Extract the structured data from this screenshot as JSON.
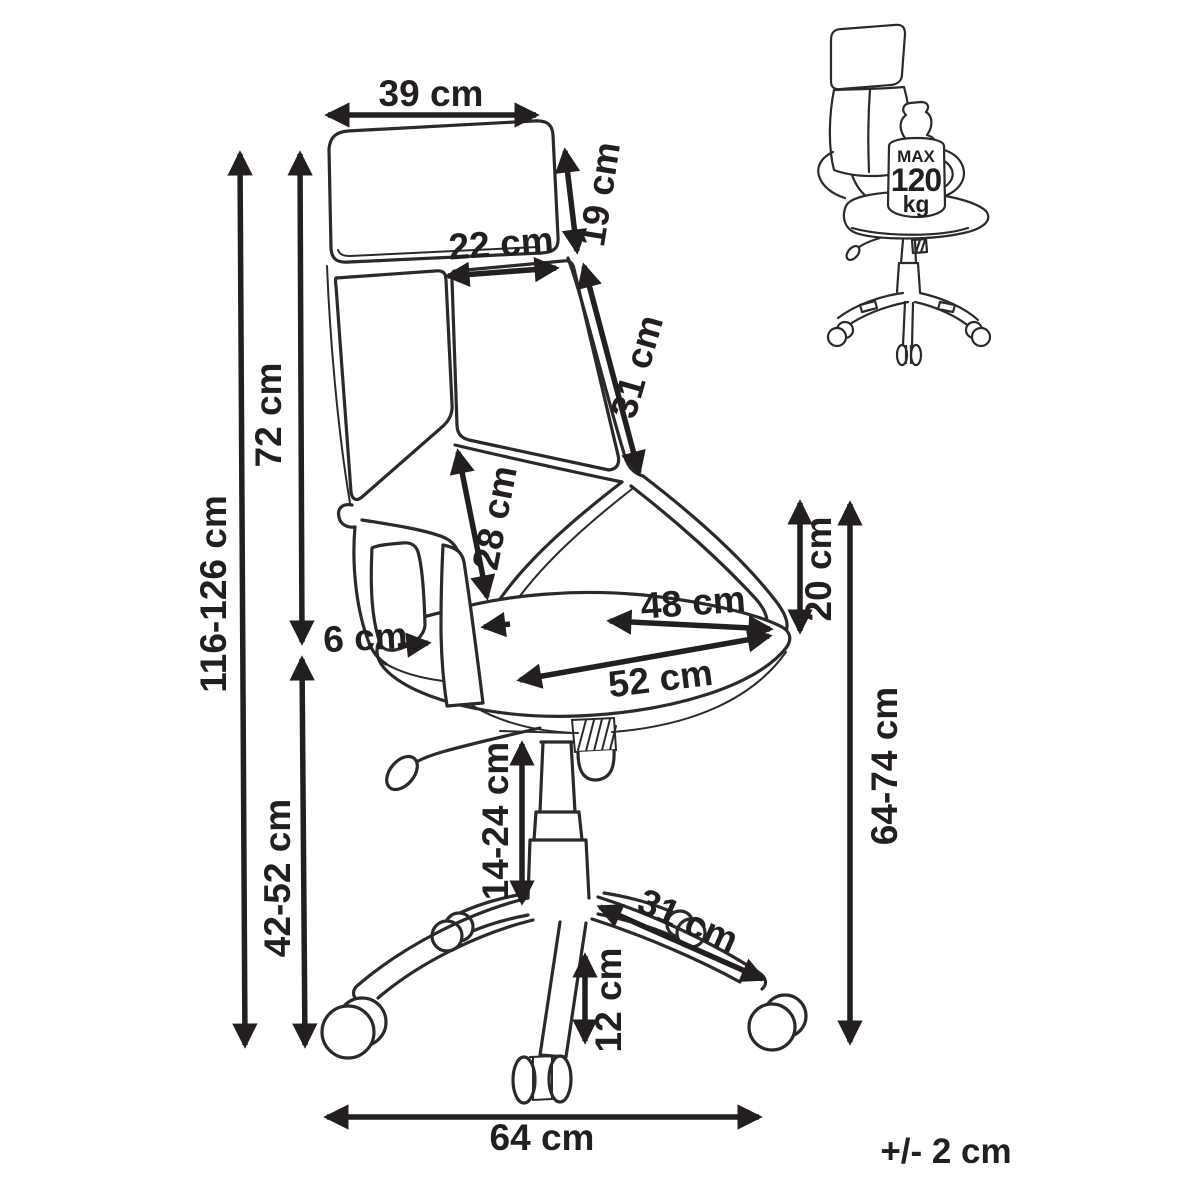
{
  "diagram": {
    "type": "office-chair-dimension-diagram",
    "tolerance": "+/- 2 cm",
    "max_load": {
      "line1": "MAX",
      "line2": "120",
      "line3": "kg"
    },
    "dims": {
      "backrest_top_width": "39 cm",
      "headrest_height": "19 cm",
      "upper_panel_width": "22 cm",
      "backrest_edge_length": "31 cm",
      "backrest_height": "72 cm",
      "total_height": "116-126 cm",
      "lumbar_seam_length": "28 cm",
      "armrest_width": "6 cm",
      "seat_width": "48 cm",
      "seat_depth": "52 cm",
      "armrest_above_seat": "20 cm",
      "seat_height": "42-52 cm",
      "gas_lift_height": "14-24 cm",
      "floor_to_armrest": "64-74 cm",
      "base_leg_length": "31 cm",
      "caster_height": "12 cm",
      "base_width": "64 cm"
    }
  }
}
